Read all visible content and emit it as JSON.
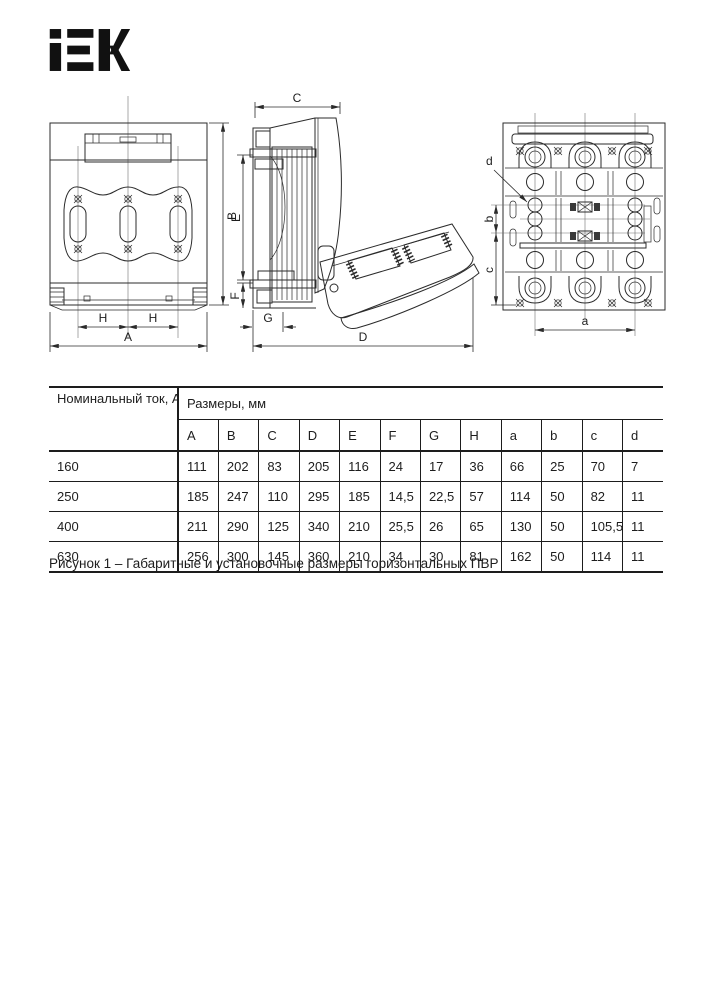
{
  "brand": {
    "logo_text": "IEK"
  },
  "figure": {
    "caption": "Рисунок 1 – Габаритные и установочные размеры горизонтальных ПВР",
    "front_view": {
      "dims": {
        "A": "A",
        "B": "B",
        "H_left": "H",
        "H_right": "H"
      }
    },
    "side_view": {
      "dims": {
        "C": "C",
        "D": "D",
        "E": "E",
        "F": "F",
        "G": "G"
      }
    },
    "rear_view": {
      "dims": {
        "a": "a",
        "b": "b",
        "c": "c",
        "d": "d"
      }
    }
  },
  "table": {
    "col_current_header": "Номинальный ток, А",
    "col_sizes_header": "Размеры, мм",
    "dim_headers": [
      "A",
      "B",
      "C",
      "D",
      "E",
      "F",
      "G",
      "H",
      "a",
      "b",
      "c",
      "d"
    ],
    "rows": [
      {
        "current": "160",
        "values": [
          "111",
          "202",
          "83",
          "205",
          "116",
          "24",
          "17",
          "36",
          "66",
          "25",
          "70",
          "7"
        ]
      },
      {
        "current": "250",
        "values": [
          "185",
          "247",
          "110",
          "295",
          "185",
          "14,5",
          "22,5",
          "57",
          "114",
          "50",
          "82",
          "11"
        ]
      },
      {
        "current": "400",
        "values": [
          "211",
          "290",
          "125",
          "340",
          "210",
          "25,5",
          "26",
          "65",
          "130",
          "50",
          "105,5",
          "11"
        ]
      },
      {
        "current": "630",
        "values": [
          "256",
          "300",
          "145",
          "360",
          "210",
          "34",
          "30",
          "81",
          "162",
          "50",
          "114",
          "11"
        ]
      }
    ]
  }
}
